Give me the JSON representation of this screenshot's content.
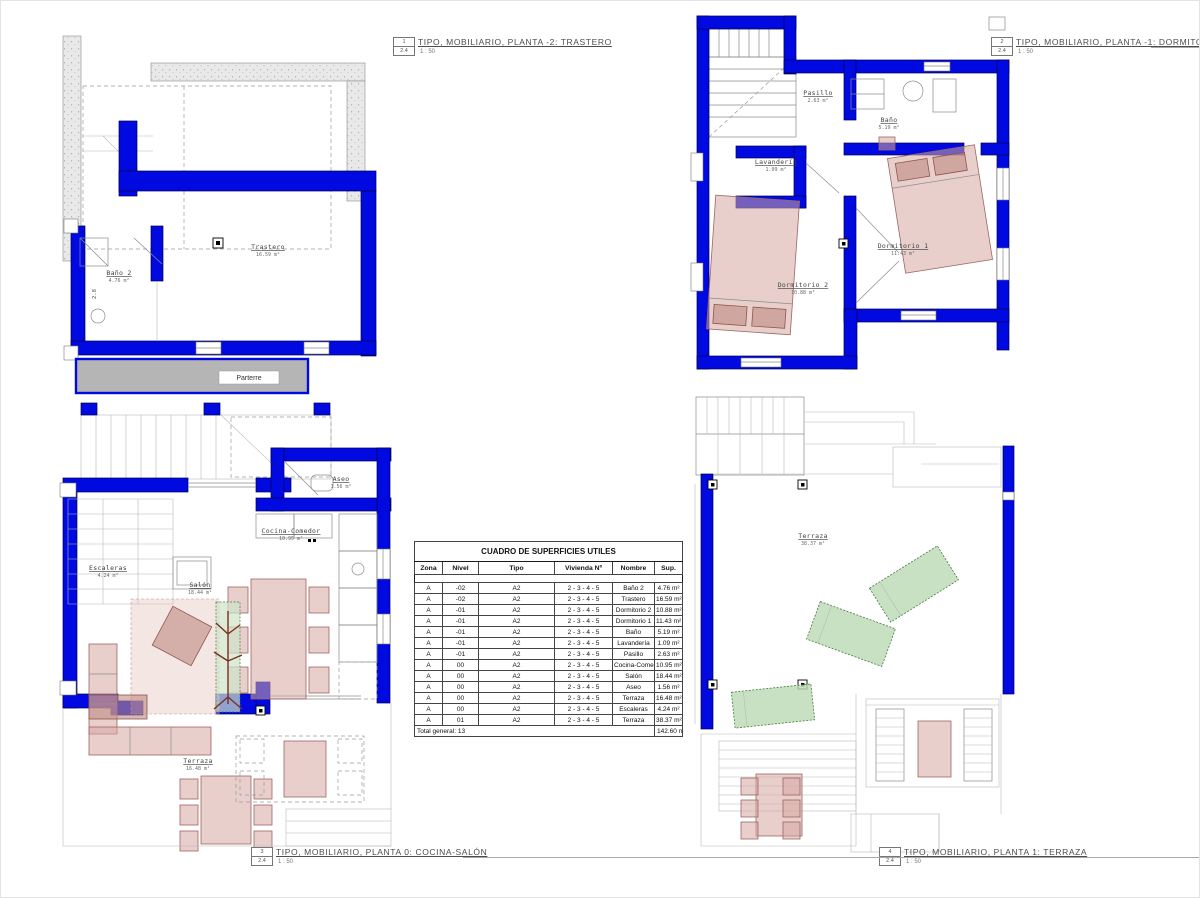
{
  "colors": {
    "wall_blue": "#000ae0",
    "furniture_pink": "#d5a8a2",
    "furniture_outline": "#9e655e",
    "terrace_green": "#bcd9b4",
    "terrace_green_outline": "#447a3c",
    "concrete_gray": "#e9e9e9",
    "parterre_gray": "#b5b5b5"
  },
  "plans": [
    {
      "drawing_number": "1",
      "sheet": "2.4",
      "title": "TIPO, MOBILIARIO, PLANTA -2: TRASTERO",
      "scale": "1 : 50",
      "dimension": "2.8",
      "annotation": "Parterre",
      "rooms": [
        {
          "name": "Baño 2",
          "area": "4.76 m²"
        },
        {
          "name": "Trastero",
          "area": "16.59 m²"
        }
      ]
    },
    {
      "drawing_number": "2",
      "sheet": "2.4",
      "title": "TIPO, MOBILIARIO, PLANTA -1: DORMITORIOS",
      "scale": "1 : 50",
      "rooms": [
        {
          "name": "Pasillo",
          "area": "2.63 m²"
        },
        {
          "name": "Baño",
          "area": "5.19 m²"
        },
        {
          "name": "Lavandería",
          "area": "1.09 m²"
        },
        {
          "name": "Dormitorio 1",
          "area": "11.43 m²"
        },
        {
          "name": "Dormitorio 2",
          "area": "10.88 m²"
        }
      ]
    },
    {
      "drawing_number": "3",
      "sheet": "2.4",
      "title": "TIPO, MOBILIARIO, PLANTA 0: COCINA-SALÓN",
      "scale": "1 : 50",
      "rooms": [
        {
          "name": "Aseo",
          "area": "1.56 m²"
        },
        {
          "name": "Cocina-Comedor",
          "area": "10.95 m²"
        },
        {
          "name": "Escaleras",
          "area": "4.24 m²"
        },
        {
          "name": "Salón",
          "area": "18.44 m²"
        },
        {
          "name": "Terraza",
          "area": "16.48 m²"
        }
      ]
    },
    {
      "drawing_number": "4",
      "sheet": "2.4",
      "title": "TIPO, MOBILIARIO, PLANTA 1: TERRAZA",
      "scale": "1 : 50",
      "rooms": [
        {
          "name": "Terraza",
          "area": "38.37 m²"
        }
      ]
    }
  ],
  "table": {
    "title": "CUADRO DE SUPERFICIES UTILES",
    "headers": [
      "Zona",
      "Nivel",
      "Tipo",
      "Vivienda Nº",
      "Nombre",
      "Sup."
    ],
    "rows": [
      [
        "A",
        "-02",
        "A2",
        "2 - 3 - 4 - 5",
        "Baño 2",
        "4.76 m²"
      ],
      [
        "A",
        "-02",
        "A2",
        "2 - 3 - 4 - 5",
        "Trastero",
        "16.59 m²"
      ],
      [
        "A",
        "-01",
        "A2",
        "2 - 3 - 4 - 5",
        "Dormitorio 2",
        "10.88 m²"
      ],
      [
        "A",
        "-01",
        "A2",
        "2 - 3 - 4 - 5",
        "Dormitorio 1",
        "11.43 m²"
      ],
      [
        "A",
        "-01",
        "A2",
        "2 - 3 - 4 - 5",
        "Baño",
        "5.19 m²"
      ],
      [
        "A",
        "-01",
        "A2",
        "2 - 3 - 4 - 5",
        "Lavandería",
        "1.09 m²"
      ],
      [
        "A",
        "-01",
        "A2",
        "2 - 3 - 4 - 5",
        "Pasillo",
        "2.63 m²"
      ],
      [
        "A",
        "00",
        "A2",
        "2 - 3 - 4 - 5",
        "Cocina-Comedor",
        "10.95 m²"
      ],
      [
        "A",
        "00",
        "A2",
        "2 - 3 - 4 - 5",
        "Salón",
        "18.44 m²"
      ],
      [
        "A",
        "00",
        "A2",
        "2 - 3 - 4 - 5",
        "Aseo",
        "1.56 m²"
      ],
      [
        "A",
        "00",
        "A2",
        "2 - 3 - 4 - 5",
        "Terraza",
        "16.48 m²"
      ],
      [
        "A",
        "00",
        "A2",
        "2 - 3 - 4 - 5",
        "Escaleras",
        "4.24 m²"
      ],
      [
        "A",
        "01",
        "A2",
        "2 - 3 - 4 - 5",
        "Terraza",
        "38.37 m²"
      ]
    ],
    "total_label": "Total general: 13",
    "total_value": "142.60 m²"
  }
}
